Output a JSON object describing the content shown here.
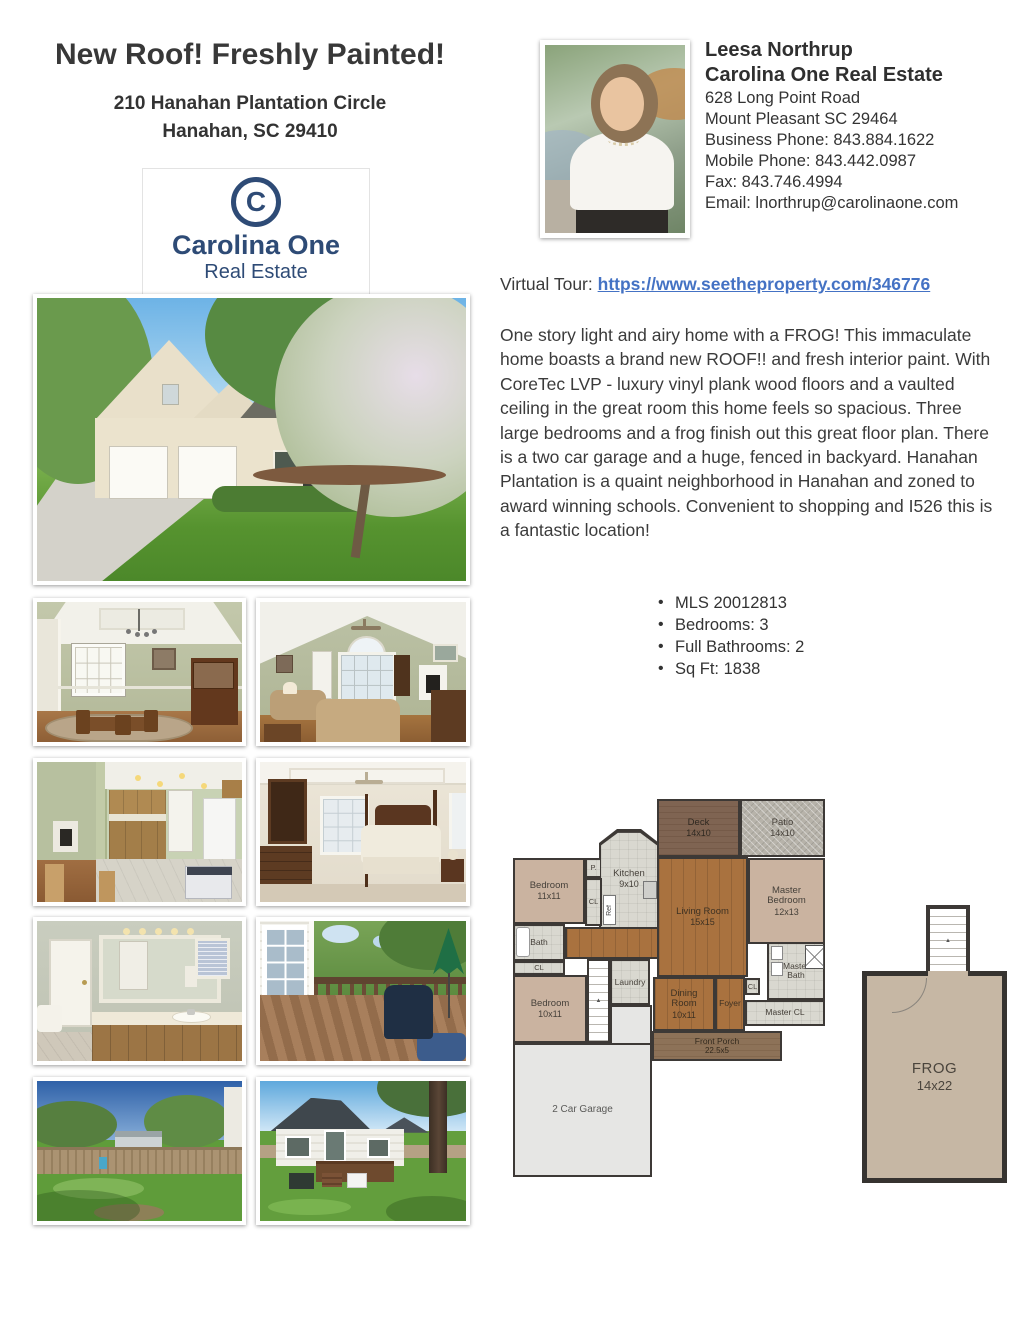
{
  "header": {
    "title": "New Roof! Freshly Painted!",
    "address_line1": "210 Hanahan Plantation Circle",
    "address_line2": "Hanahan, SC 29410"
  },
  "logo": {
    "monogram": "C",
    "name": "Carolina One",
    "subtitle": "Real Estate",
    "color": "#2e4b76"
  },
  "agent": {
    "name": "Leesa Northrup",
    "company": "Carolina One Real Estate",
    "address_line1": "628 Long Point Road",
    "address_line2": "Mount Pleasant SC 29464",
    "business_phone": "Business Phone: 843.884.1622",
    "mobile_phone": "Mobile Phone: 843.442.0987",
    "fax": "Fax: 843.746.4994",
    "email": "Email: lnorthrup@carolinaone.com"
  },
  "tour": {
    "label": "Virtual Tour:",
    "url": "https://www.seetheproperty.com/346776",
    "link_color": "#4472c4"
  },
  "description": "One story light and airy home with a FROG! This immaculate home boasts a brand new ROOF!! and fresh interior paint. With CoreTec LVP - luxury vinyl plank wood floors and a vaulted ceiling in the great room this home feels so spacious. Three large bedrooms and a frog finish out this great floor plan. There is a two car garage and a huge, fenced in backyard. Hanahan Plantation is a quaint neighborhood in Hanahan and zoned to award winning schools. Convenient to shopping and I526 this is a fantastic location!",
  "details": {
    "items": [
      "MLS 20012813",
      "Bedrooms: 3",
      "Full Bathrooms: 2",
      "Sq Ft: 1838"
    ]
  },
  "floorplan": {
    "deck": {
      "label": "Deck",
      "size": "14x10"
    },
    "patio": {
      "label": "Patio",
      "size": "14x10"
    },
    "bedroom1": {
      "label": "Bedroom",
      "size": "11x11"
    },
    "pantry": {
      "label": "P."
    },
    "kitchen": {
      "label": "Kitchen",
      "size": "9x10"
    },
    "cl_kitchen": {
      "label": "CL"
    },
    "living": {
      "label": "Living Room",
      "size": "15x15"
    },
    "master_bedroom": {
      "label": "Master Bedroom",
      "size": "12x13"
    },
    "bath": {
      "label": "Bath"
    },
    "cl_hall": {
      "label": "CL"
    },
    "bedroom2": {
      "label": "Bedroom",
      "size": "10x11"
    },
    "laundry": {
      "label": "Laundry"
    },
    "dining": {
      "label": "Dining Room",
      "size": "10x11"
    },
    "foyer": {
      "label": "Foyer"
    },
    "cl_foyer": {
      "label": "CL"
    },
    "master_bath": {
      "label": "Master Bath"
    },
    "master_cl": {
      "label": "Master CL"
    },
    "front_porch": {
      "label": "Front Porch",
      "size": "22.5x5"
    },
    "garage": {
      "label": "2 Car Garage"
    },
    "ref": {
      "label": "Ref"
    },
    "frog": {
      "label": "FROG",
      "size": "14x22"
    }
  }
}
